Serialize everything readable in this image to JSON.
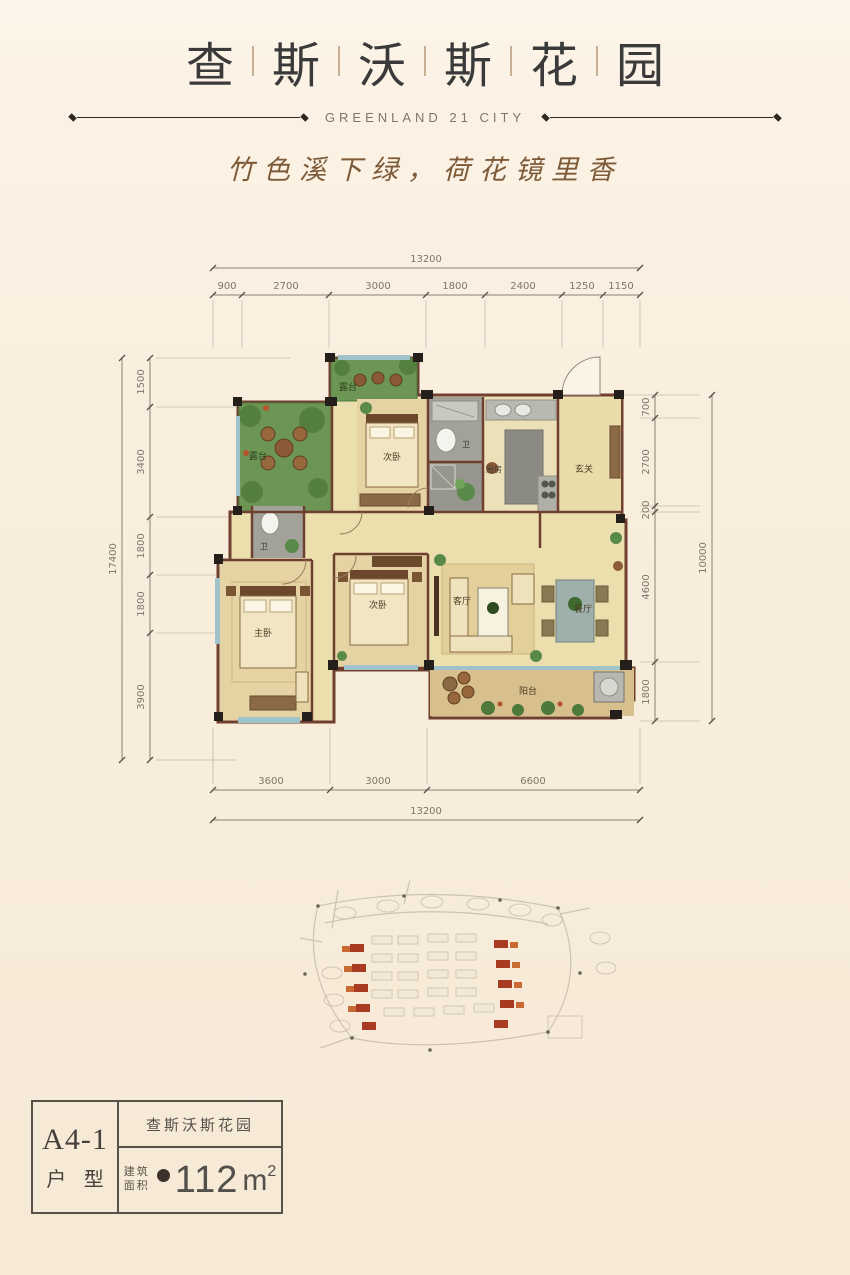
{
  "header": {
    "title_chars": [
      "查",
      "斯",
      "沃",
      "斯",
      "花",
      "园"
    ],
    "subtitle": "GREENLAND 21 CITY",
    "tagline": "竹色溪下绿，荷花镜里香"
  },
  "floor_plan": {
    "dims": {
      "top_total": "13200",
      "top_segments": [
        "900",
        "2700",
        "3000",
        "1800",
        "2400",
        "1250",
        "1150"
      ],
      "left_total": "17400",
      "left_segments": [
        "1500",
        "3400",
        "1800",
        "1800",
        "3900"
      ],
      "right_total": "10000",
      "right_segments": [
        "700",
        "2700",
        "200",
        "4600",
        "1800"
      ],
      "bottom_total": "13200",
      "bottom_segments": [
        "3600",
        "3000",
        "6600"
      ]
    },
    "rooms": {
      "terrace_top": "露台",
      "terrace_left": "露台",
      "bedroom_top": "次卧",
      "bath_top": "卫",
      "kitchen": "厨房",
      "entry": "玄关",
      "bath_mid": "卫",
      "master": "主卧",
      "bedroom_mid": "次卧",
      "living": "客厅",
      "dining": "餐厅",
      "balcony": "阳台"
    }
  },
  "unit_card": {
    "unit_code": "A4-1",
    "unit_type_label": "户 型",
    "project_name": "查斯沃斯花园",
    "area_label_line1": "建筑",
    "area_label_line2": "面积",
    "area_value": "112",
    "area_unit": "m",
    "area_exponent": "2"
  }
}
